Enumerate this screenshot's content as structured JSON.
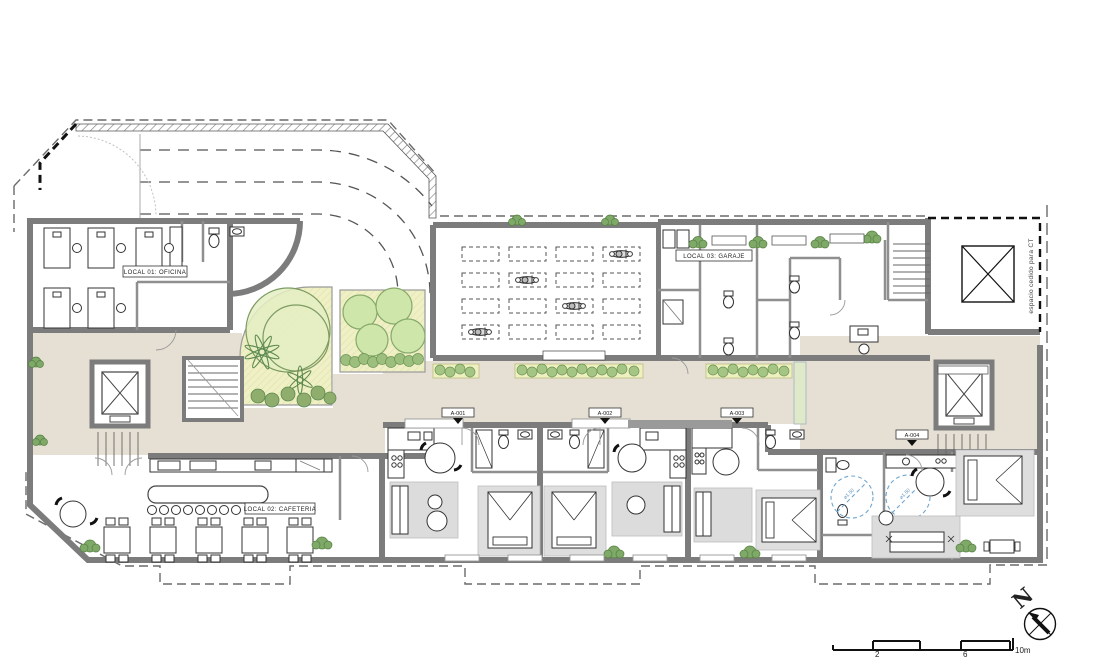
{
  "labels": {
    "office": "LOCAL 01: OFICINA",
    "cafeteria": "LOCAL 02: CAFETERIA",
    "garage": "LOCAL 03: GARAJE",
    "ct_space": "espacio cedido para CT"
  },
  "units": [
    {
      "id": "A-001"
    },
    {
      "id": "A-002"
    },
    {
      "id": "A-003"
    },
    {
      "id": "A-004"
    }
  ],
  "annotations": {
    "turning_radius": "⌀1.50"
  },
  "compass": {
    "north_label": "N"
  },
  "scale_bar": {
    "ticks": [
      "2",
      "6",
      "10m"
    ]
  },
  "colors": {
    "wall": "#7c7c7c",
    "floor": "#e5dfd4",
    "garden": "#eff0c6",
    "tree": "#cfe6aa",
    "shrub": "#8fae6d",
    "rug": "#dcdcdc",
    "accent_blue": "#6fa6cf"
  }
}
